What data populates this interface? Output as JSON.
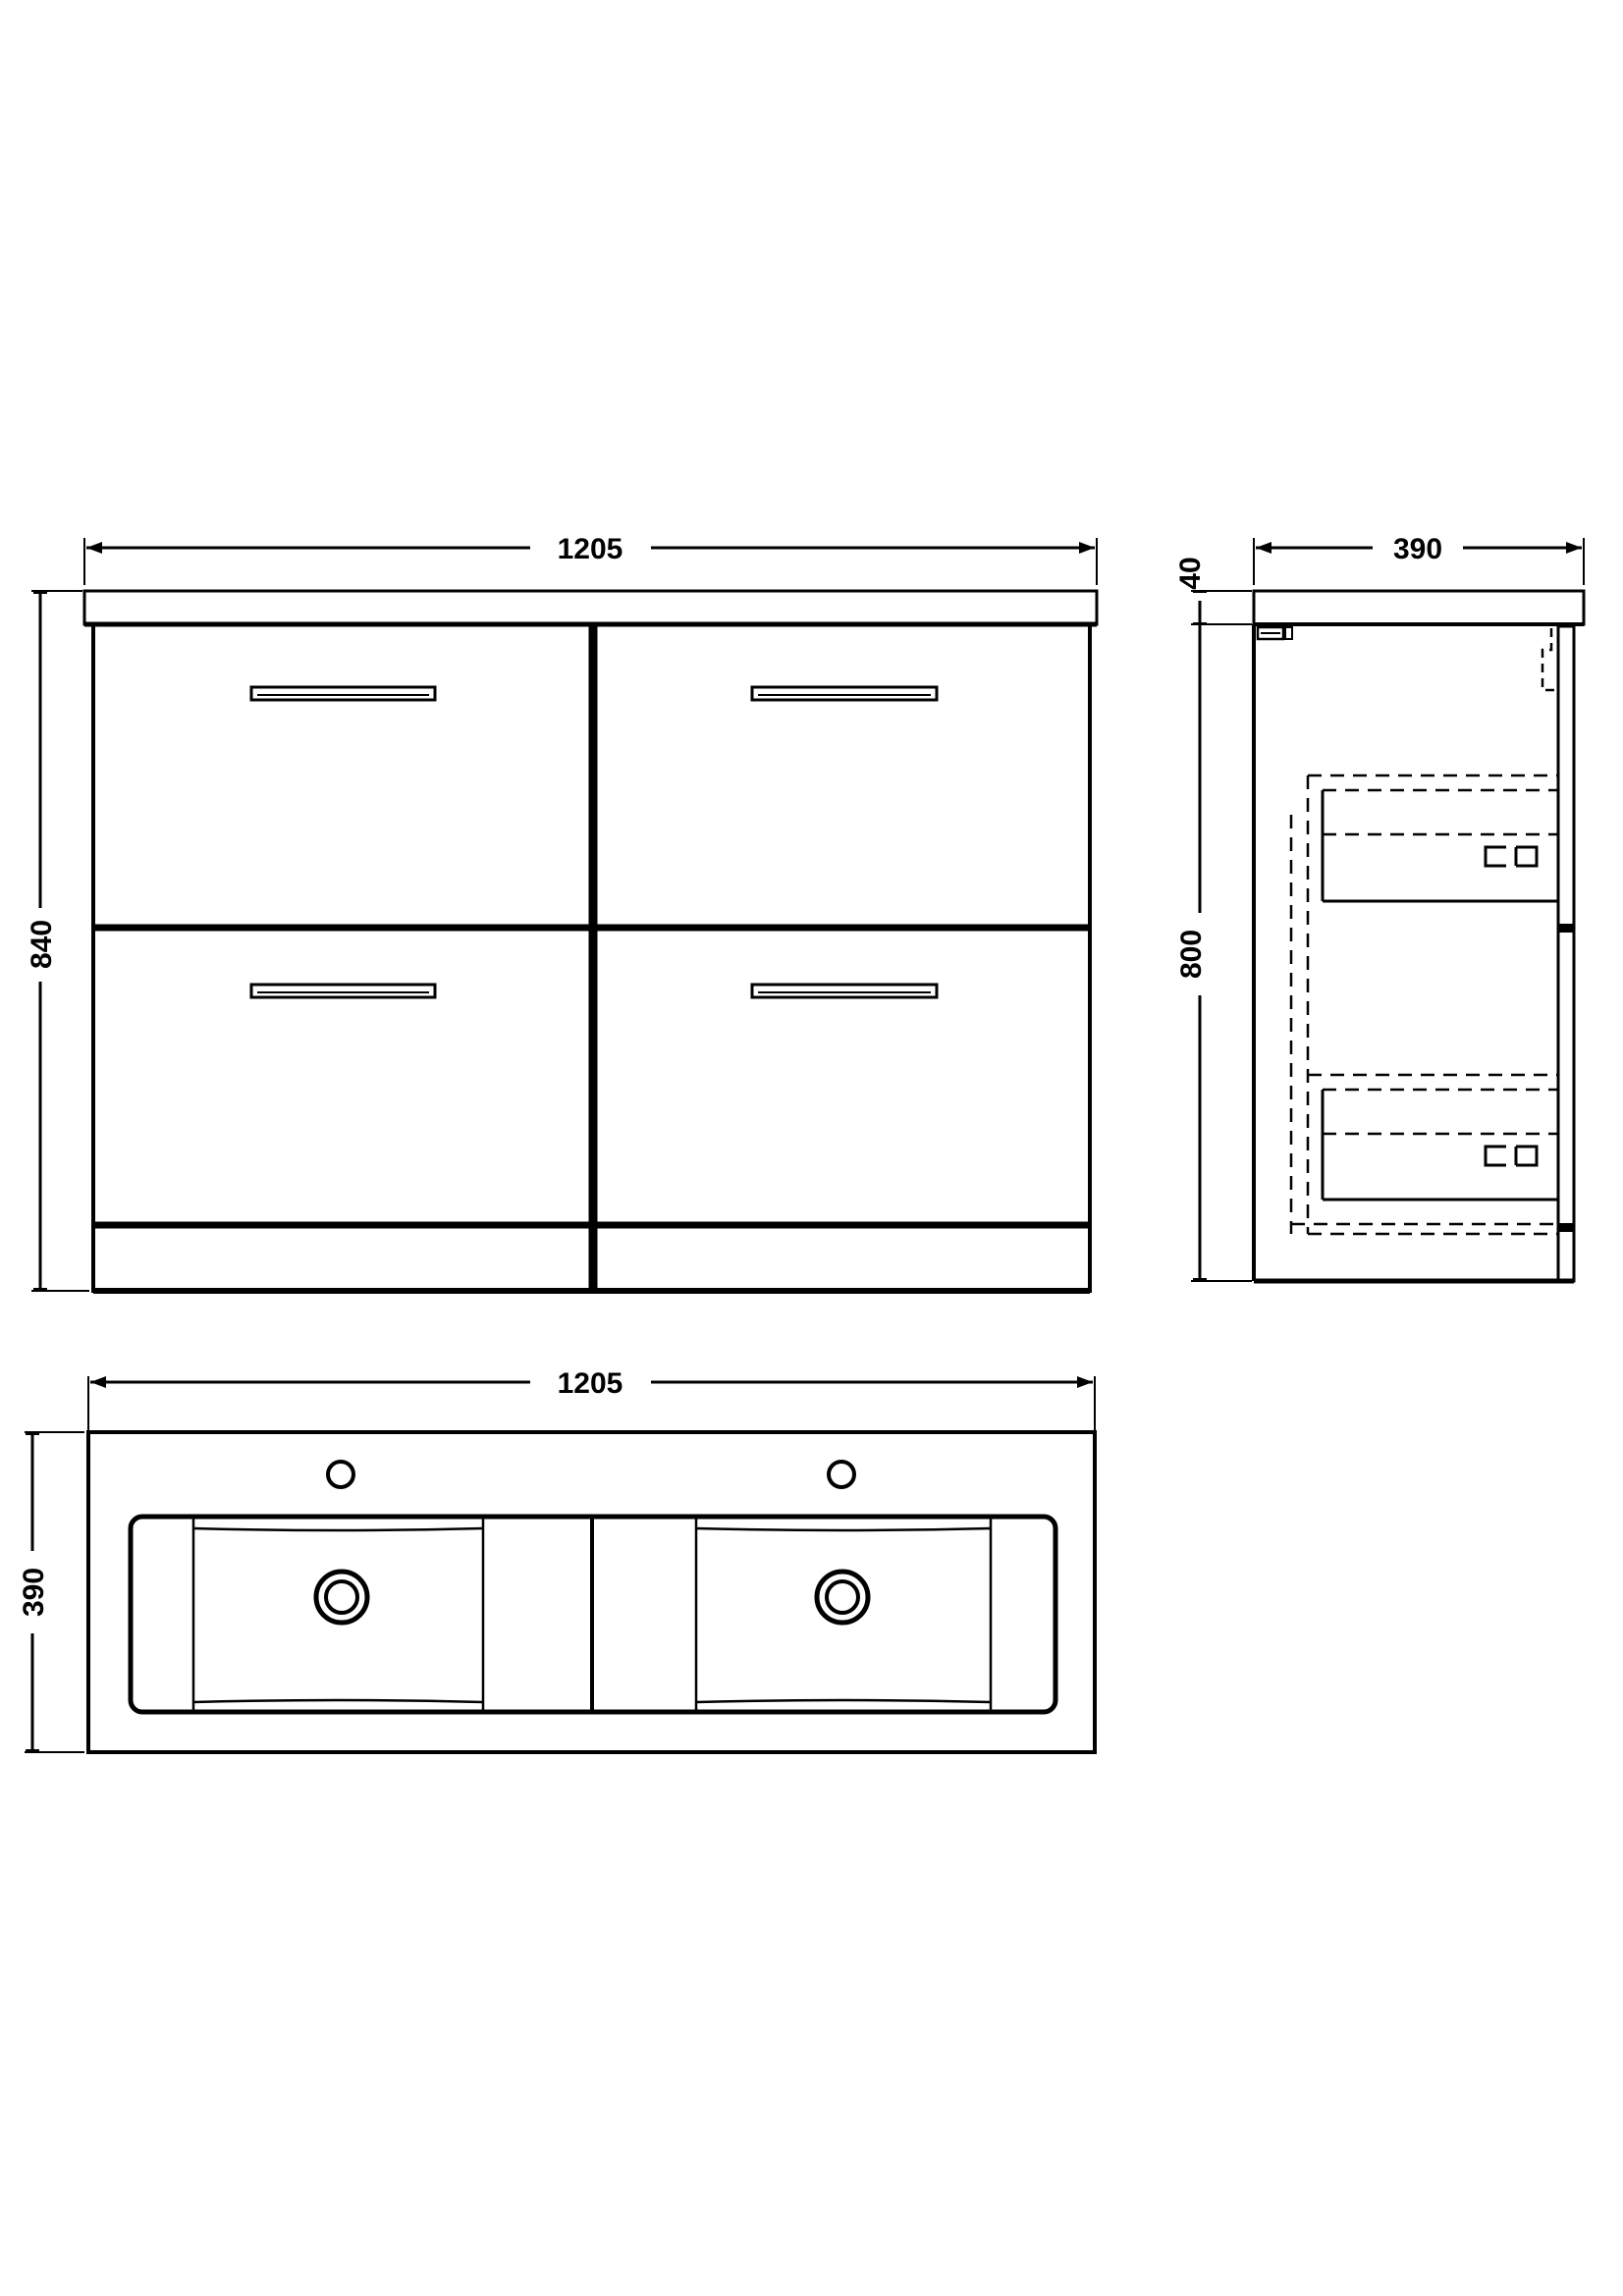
{
  "app": {
    "title": "Bathroom vanity unit technical drawing",
    "background_color": "#ffffff",
    "line_color": "#000000"
  },
  "views": {
    "front": {
      "label": "front-elevation",
      "width_label": "1205",
      "height_label": "840",
      "width_mm": 1205,
      "height_mm": 840,
      "drawer_count": 4
    },
    "side": {
      "label": "side-elevation",
      "depth_label": "390",
      "worktop_thickness_label": "40",
      "cabinet_height_label": "800",
      "depth_mm": 390,
      "worktop_thickness_mm": 40,
      "cabinet_height_mm": 800
    },
    "plan": {
      "label": "plan-view",
      "width_label": "1205",
      "depth_label": "390",
      "width_mm": 1205,
      "depth_mm": 390,
      "basin_count": 2,
      "tap_hole_count": 2
    }
  }
}
